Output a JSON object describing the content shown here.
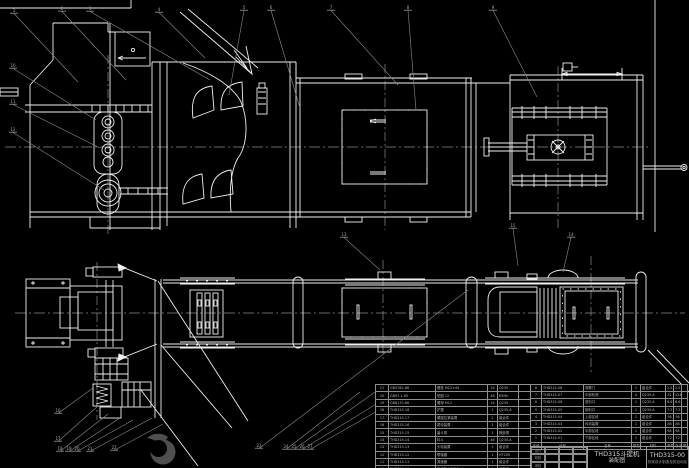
{
  "drawing_title": {
    "name": "THD315斗提机",
    "view_label": "装配图",
    "number": "THD315-00",
    "org": "机械设计制造及其自动化"
  },
  "title_block": {
    "sig_rows": [
      "设计",
      "校核",
      "审核"
    ]
  },
  "bom": {
    "header": [
      "序号",
      "代号",
      "名称",
      "数量",
      "材料",
      "单件",
      "总计",
      "附注"
    ],
    "right_rows": [
      [
        "8",
        "THD315-08",
        "观察门",
        "1",
        "组合件",
        "2.5",
        "2.5",
        ""
      ],
      [
        "7",
        "THD315-07",
        "中部机壳",
        "4",
        "Q235-A",
        "31",
        "124",
        ""
      ],
      [
        "6",
        "THD315-06",
        "进料口",
        "1",
        "Q235-A",
        "8.6",
        "8.6",
        ""
      ],
      [
        "5",
        "THD315-05",
        "卸料口",
        "1",
        "Q235-A",
        "7.2",
        "7.2",
        ""
      ],
      [
        "4",
        "THD315-04",
        "上部区段",
        "1",
        "组合件",
        "56",
        "56",
        ""
      ],
      [
        "3",
        "THD315-03",
        "传动装置",
        "1",
        "组合件",
        "88",
        "88",
        ""
      ],
      [
        "2",
        "THD315-02",
        "中部区段",
        "1",
        "组合件",
        "64",
        "64",
        ""
      ],
      [
        "1",
        "THD315-01",
        "下部区段",
        "1",
        "组合件",
        "72",
        "72",
        ""
      ]
    ],
    "left_rows": [
      [
        "21",
        "GB5782-86",
        "螺栓 M12×45",
        "24",
        "Q235",
        ""
      ],
      [
        "20",
        "GB97.1-85",
        "垫圈 12",
        "48",
        "65Mn",
        ""
      ],
      [
        "19",
        "GB6170-86",
        "螺母 M12",
        "24",
        "Q235",
        ""
      ],
      [
        "18",
        "THD315-18",
        "护罩",
        "1",
        "Q235-A",
        ""
      ],
      [
        "17",
        "THD315-17",
        "螺旋拉紧装置",
        "2",
        "组合件",
        ""
      ],
      [
        "16",
        "THD315-16",
        "尾轮装置",
        "1",
        "组合件",
        ""
      ],
      [
        "15",
        "THD315-15",
        "畚斗带",
        "1",
        "橡胶带",
        ""
      ],
      [
        "14",
        "THD315-14",
        "料斗",
        "46",
        "Q235-A",
        ""
      ],
      [
        "13",
        "THD315-13",
        "头轮装置",
        "1",
        "组合件",
        ""
      ],
      [
        "12",
        "THD315-12",
        "联轴器",
        "1",
        "HT200",
        ""
      ],
      [
        "11",
        "THD315-11",
        "减速器",
        "1",
        "组合件",
        ""
      ],
      [
        "10",
        "THD315-10",
        "电动机 Y132M-4",
        "1",
        "外购件",
        ""
      ],
      [
        "9",
        "THD315-09",
        "机座",
        "1",
        "Q235-A",
        ""
      ]
    ]
  },
  "callouts": {
    "labels": [
      "1",
      "2",
      "3",
      "4",
      "5",
      "6",
      "7",
      "8",
      "9",
      "10",
      "11",
      "12",
      "13",
      "14",
      "15",
      "16",
      "17",
      "18",
      "19",
      "20",
      "21",
      "22",
      "23",
      "24",
      "25",
      "26",
      "27"
    ]
  },
  "colors": {
    "background": "#000000",
    "line": "#f0f0f0",
    "secondary": "#8c8c8c",
    "table_line": "#9a9a9a",
    "text": "#b5b5b5"
  }
}
